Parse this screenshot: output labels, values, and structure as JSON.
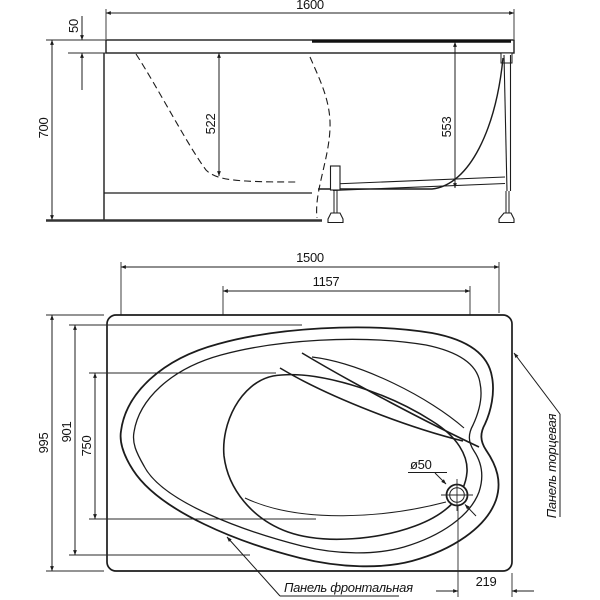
{
  "side_view": {
    "overall_length": "1600",
    "rim_thickness": "50",
    "overall_height": "700",
    "depth_front": "522",
    "depth_back": "553"
  },
  "plan_view": {
    "shell_length": "1500",
    "basin_length": "1157",
    "overall_width": "995",
    "shell_width": "901",
    "basin_width": "750",
    "drain_diameter": "ø50",
    "drain_offset": "219",
    "front_panel_label": "Панель фронтальная",
    "end_panel_label": "Панель торцевая"
  },
  "colors": {
    "line": "#1c1c1c",
    "background": "#ffffff"
  }
}
